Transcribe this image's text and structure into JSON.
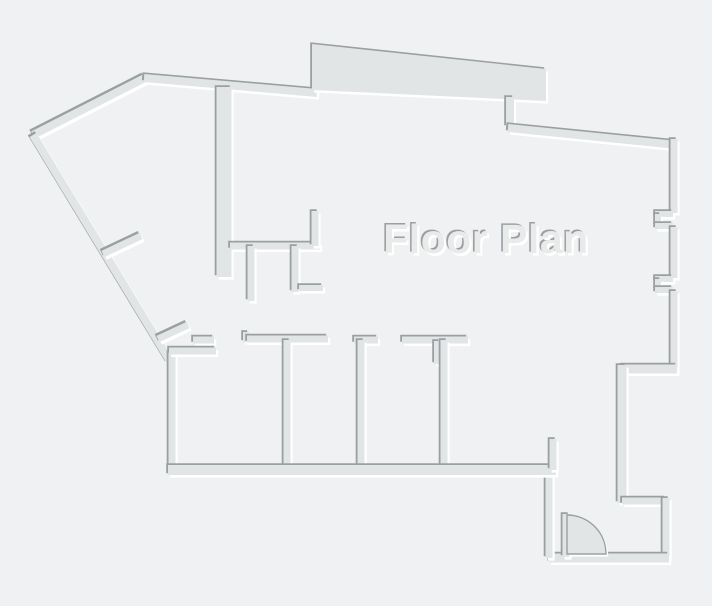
{
  "title": "Floor Plan",
  "canvas": {
    "width": 712,
    "height": 606
  },
  "colors": {
    "background": "#f0f1f2",
    "wall_fill": "#e2e5e6",
    "wall_shadow": "#9aa0a1",
    "wall_highlight": "#ffffff",
    "label_fill": "#e9ebeb"
  },
  "label": {
    "text": "Floor Plan",
    "x": 486,
    "y": 253,
    "font_size": 41,
    "font_weight": "bold",
    "letter_spacing": 0.5
  },
  "bay": {
    "name": "top-bay-wall",
    "points": [
      [
        312,
        44
      ],
      [
        546,
        69
      ],
      [
        546,
        101
      ],
      [
        312,
        90
      ]
    ]
  },
  "door": {
    "name": "entry-door-swing",
    "hinge_x": 567,
    "hinge_y": 554,
    "radius": 39
  },
  "walls": [
    {
      "name": "northwest-diagonal-wall",
      "x1": 33,
      "y1": 135,
      "x2": 145,
      "y2": 78,
      "w": 8
    },
    {
      "name": "top-left-wall",
      "x1": 144,
      "y1": 78,
      "x2": 317,
      "y2": 93,
      "w": 8
    },
    {
      "name": "bay-right-jog-wall",
      "x1": 510,
      "y1": 97,
      "x2": 510,
      "y2": 127,
      "w": 8
    },
    {
      "name": "top-right-wall",
      "x1": 508,
      "y1": 128,
      "x2": 677,
      "y2": 145,
      "w": 8
    },
    {
      "name": "right-wall-upper",
      "x1": 674,
      "y1": 139,
      "x2": 674,
      "y2": 213,
      "w": 7
    },
    {
      "name": "window-notch1-top",
      "x1": 655,
      "y1": 214,
      "x2": 673,
      "y2": 214,
      "w": 6
    },
    {
      "name": "window-notch1-left",
      "x1": 658,
      "y1": 214,
      "x2": 658,
      "y2": 226,
      "w": 6
    },
    {
      "name": "window-notch1-bottom",
      "x1": 655,
      "y1": 226,
      "x2": 673,
      "y2": 226,
      "w": 6
    },
    {
      "name": "right-wall-middle",
      "x1": 674,
      "y1": 227,
      "x2": 674,
      "y2": 278,
      "w": 7
    },
    {
      "name": "window-notch2-top",
      "x1": 655,
      "y1": 279,
      "x2": 673,
      "y2": 279,
      "w": 6
    },
    {
      "name": "window-notch2-left",
      "x1": 658,
      "y1": 279,
      "x2": 658,
      "y2": 290,
      "w": 6
    },
    {
      "name": "window-notch2-bottom",
      "x1": 655,
      "y1": 290,
      "x2": 673,
      "y2": 290,
      "w": 6
    },
    {
      "name": "right-wall-lower",
      "x1": 674,
      "y1": 291,
      "x2": 674,
      "y2": 372,
      "w": 7
    },
    {
      "name": "right-jog-wall",
      "x1": 622,
      "y1": 369,
      "x2": 677,
      "y2": 369,
      "w": 9
    },
    {
      "name": "right-wall-bottom",
      "x1": 622,
      "y1": 365,
      "x2": 622,
      "y2": 503,
      "w": 9
    },
    {
      "name": "entry-jog-wall",
      "x1": 622,
      "y1": 501,
      "x2": 666,
      "y2": 501,
      "w": 7
    },
    {
      "name": "entry-right-wall",
      "x1": 666,
      "y1": 498,
      "x2": 666,
      "y2": 558,
      "w": 7
    },
    {
      "name": "entry-bottom-wall",
      "x1": 549,
      "y1": 558,
      "x2": 669,
      "y2": 558,
      "w": 9
    },
    {
      "name": "entry-left-wall",
      "x1": 549,
      "y1": 469,
      "x2": 549,
      "y2": 558,
      "w": 7
    },
    {
      "name": "west-diagonal-wall",
      "x1": 33,
      "y1": 135,
      "x2": 170,
      "y2": 361,
      "w": 8
    },
    {
      "name": "west-vertical-wall",
      "x1": 172,
      "y1": 352,
      "x2": 172,
      "y2": 469,
      "w": 7
    },
    {
      "name": "west-diagonal-stub-upper",
      "x1": 103,
      "y1": 254,
      "x2": 141,
      "y2": 236,
      "w": 7
    },
    {
      "name": "west-diagonal-stub-lower",
      "x1": 158,
      "y1": 339,
      "x2": 188,
      "y2": 325,
      "w": 7
    },
    {
      "name": "interior-main-vertical-wall",
      "x1": 224,
      "y1": 87,
      "x2": 224,
      "y2": 277,
      "w": 15
    },
    {
      "name": "interior-horizontal-wall",
      "x1": 230,
      "y1": 246,
      "x2": 320,
      "y2": 246,
      "w": 7
    },
    {
      "name": "interior-stub-up",
      "x1": 315,
      "y1": 211,
      "x2": 315,
      "y2": 246,
      "w": 7
    },
    {
      "name": "interior-hanging-wall1",
      "x1": 251,
      "y1": 246,
      "x2": 251,
      "y2": 301,
      "w": 7
    },
    {
      "name": "interior-hanging-wall2",
      "x1": 295,
      "y1": 246,
      "x2": 295,
      "y2": 292,
      "w": 7
    },
    {
      "name": "interior-dash-wall",
      "x1": 299,
      "y1": 288,
      "x2": 323,
      "y2": 288,
      "w": 6
    },
    {
      "name": "corridor-dash-wall",
      "x1": 193,
      "y1": 340,
      "x2": 214,
      "y2": 340,
      "w": 7
    },
    {
      "name": "room1-top-wall",
      "x1": 169,
      "y1": 351,
      "x2": 216,
      "y2": 351,
      "w": 7
    },
    {
      "name": "corridor-door-jamb",
      "x1": 246,
      "y1": 332,
      "x2": 246,
      "y2": 342,
      "w": 6
    },
    {
      "name": "corridor-wall",
      "x1": 247,
      "y1": 339,
      "x2": 328,
      "y2": 339,
      "w": 7
    },
    {
      "name": "corridor-stub-wall",
      "x1": 354,
      "y1": 340,
      "x2": 378,
      "y2": 340,
      "w": 7
    },
    {
      "name": "corridor-t-wall",
      "x1": 402,
      "y1": 340,
      "x2": 468,
      "y2": 340,
      "w": 7
    },
    {
      "name": "room-divider1",
      "x1": 287,
      "y1": 340,
      "x2": 287,
      "y2": 467,
      "w": 7
    },
    {
      "name": "room-divider2",
      "x1": 361,
      "y1": 340,
      "x2": 361,
      "y2": 467,
      "w": 7
    },
    {
      "name": "t-wall-hanging-stub",
      "x1": 437,
      "y1": 341,
      "x2": 437,
      "y2": 364,
      "w": 6
    },
    {
      "name": "room-divider3",
      "x1": 444,
      "y1": 340,
      "x2": 444,
      "y2": 467,
      "w": 7
    },
    {
      "name": "rooms-bottom-wall",
      "x1": 168,
      "y1": 470,
      "x2": 556,
      "y2": 470,
      "w": 10
    },
    {
      "name": "bottom-wall-end-stub",
      "x1": 553,
      "y1": 439,
      "x2": 553,
      "y2": 470,
      "w": 7
    },
    {
      "name": "door-hinge-stub",
      "x1": 566,
      "y1": 514,
      "x2": 566,
      "y2": 557,
      "w": 7
    }
  ]
}
